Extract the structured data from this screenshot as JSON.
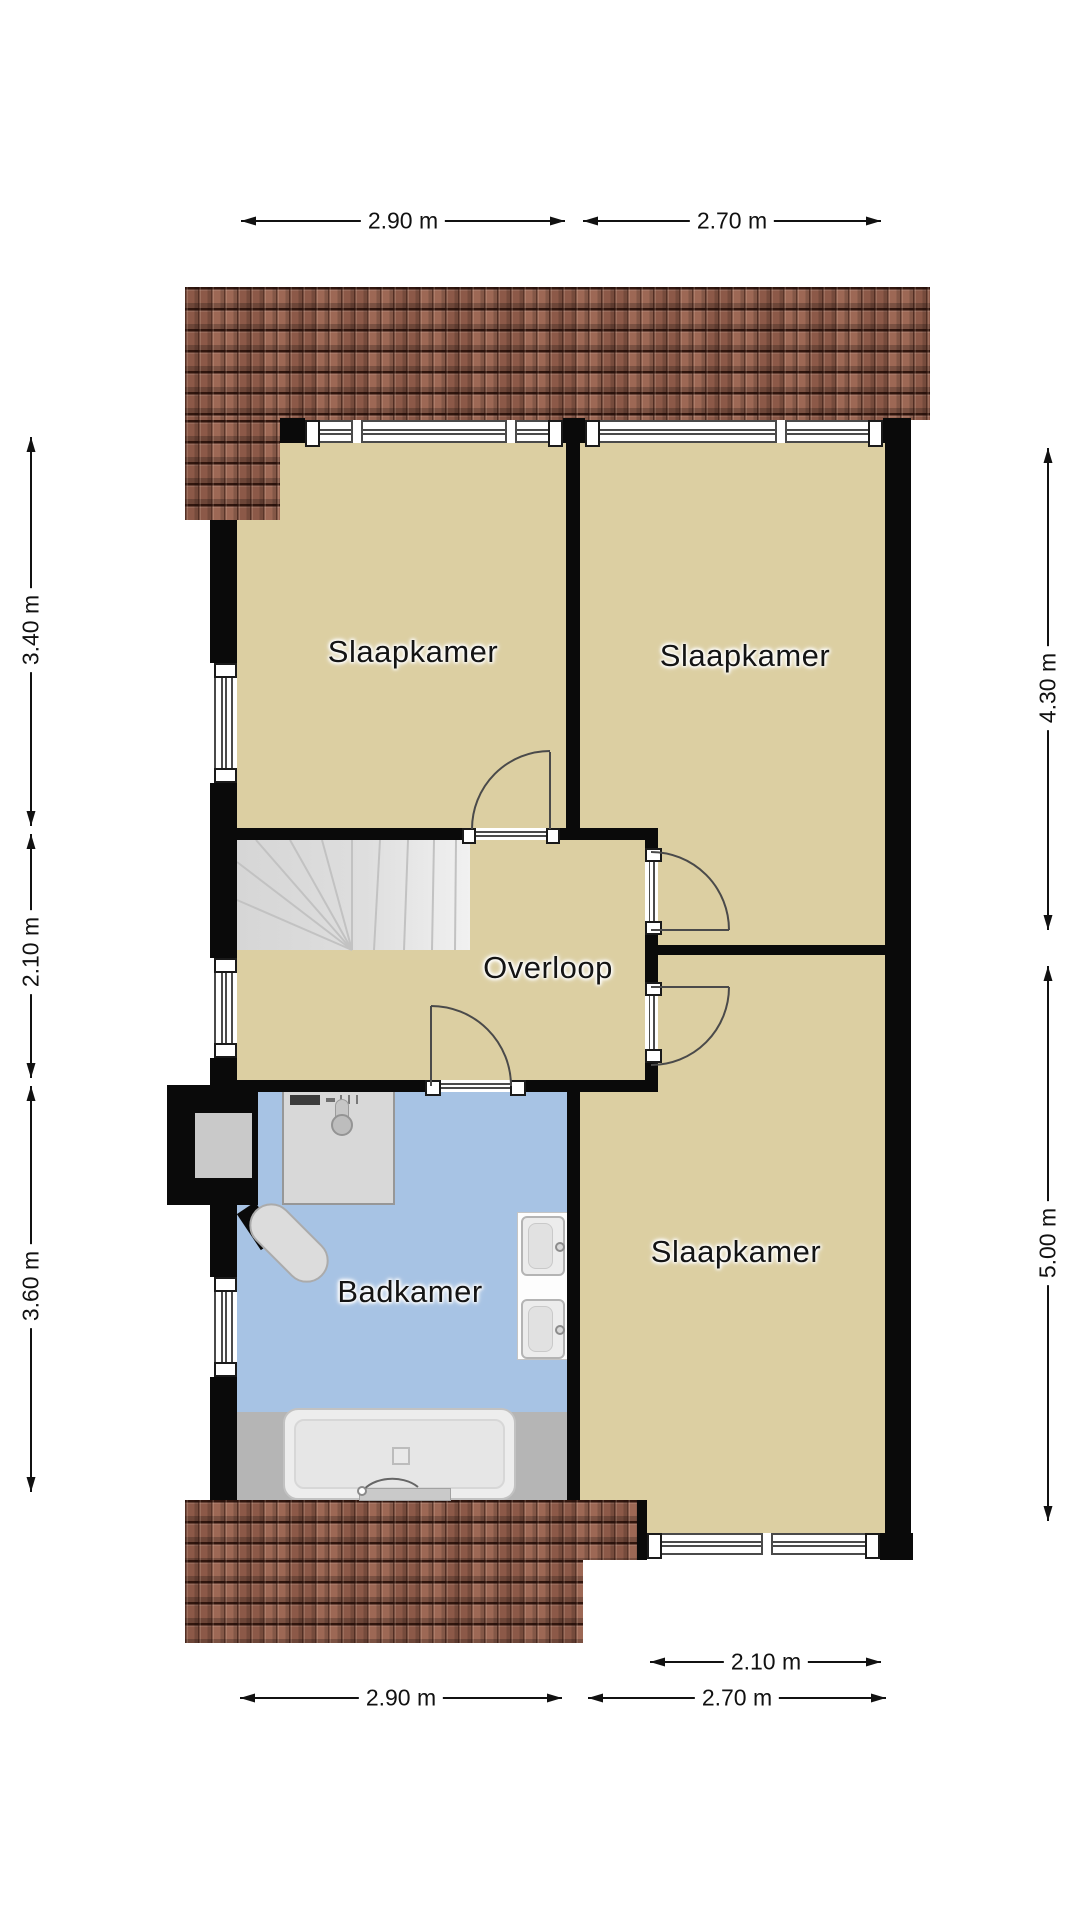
{
  "plan_title": "floorplan-second-floor",
  "rooms": {
    "bedroom_tl": "Slaapkamer",
    "bedroom_tr": "Slaapkamer",
    "bedroom_br": "Slaapkamer",
    "landing": "Overloop",
    "bathroom": "Badkamer"
  },
  "dims": {
    "top_1": "2.90 m",
    "top_2": "2.70 m",
    "left_1": "3.40 m",
    "left_2": "2.10 m",
    "left_3": "3.60 m",
    "right_1": "4.30 m",
    "right_2": "5.00 m",
    "bottom_inner": "2.10 m",
    "bottom_1": "2.90 m",
    "bottom_2": "2.70 m"
  },
  "colors": {
    "room_beige": "#dccfa2",
    "bathroom_blue": "#a7c3e4",
    "roof_brown": "#96614f",
    "wall_black": "#0a0a0a",
    "stair_gray": "#d8d8d8",
    "bath_zone_gray": "#b5b5b5"
  },
  "fixtures": {
    "stairs": "winder-staircase",
    "washer": "washing-machine",
    "toilet": "toilet",
    "sinks": "two-washbasins",
    "bathtub": "bathtub",
    "chimney": "chimney-duct"
  }
}
